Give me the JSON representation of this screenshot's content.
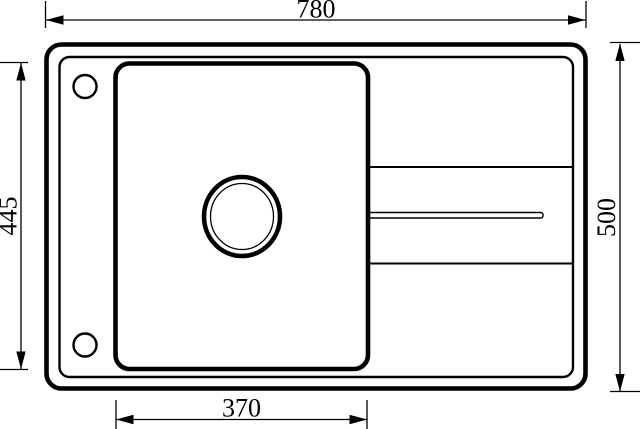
{
  "page": {
    "background_color": "#ffffff",
    "line_color": "#000000",
    "description": "Technical top-view dimension drawing of a kitchen sink with single bowl, drainboard grooves and faucet holes"
  },
  "drawing": {
    "dimensions": {
      "overall_width": "780",
      "overall_depth": "500",
      "bowl_depth": "445",
      "bowl_width": "370"
    }
  }
}
